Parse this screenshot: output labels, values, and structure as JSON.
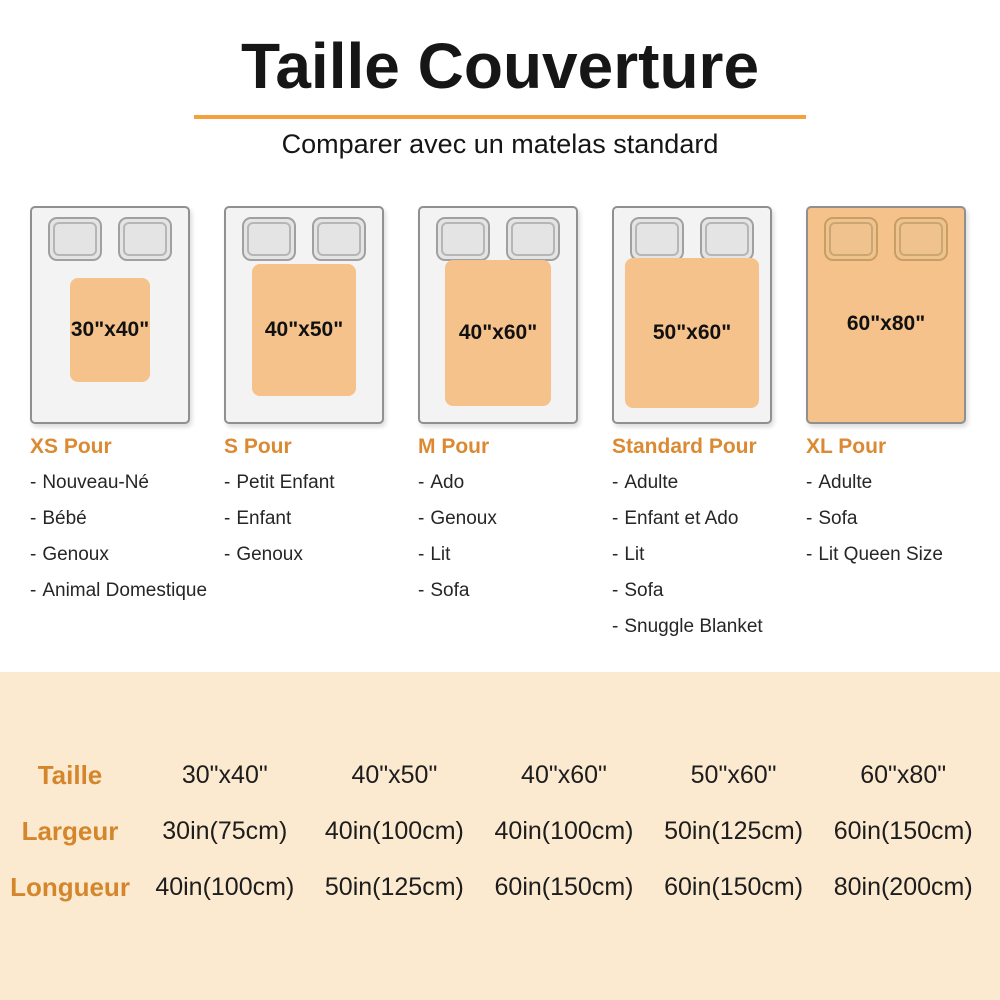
{
  "header": {
    "title": "Taille Couverture",
    "subtitle": "Comparer avec un matelas standard"
  },
  "bullet": "-",
  "beds": [
    {
      "blanket_size": "30\"x40\"",
      "category": "XS Pour",
      "uses": [
        "Nouveau-Né",
        "Bébé",
        "Genoux",
        "Animal Domestique"
      ]
    },
    {
      "blanket_size": "40\"x50\"",
      "category": "S Pour",
      "uses": [
        "Petit Enfant",
        "Enfant",
        "Genoux"
      ]
    },
    {
      "blanket_size": "40\"x60\"",
      "category": "M Pour",
      "uses": [
        "Ado",
        "Genoux",
        "Lit",
        "Sofa"
      ]
    },
    {
      "blanket_size": "50\"x60\"",
      "category": "Standard Pour",
      "uses": [
        "Adulte",
        "Enfant et Ado",
        "Lit",
        "Sofa",
        "Snuggle Blanket"
      ]
    },
    {
      "blanket_size": "60\"x80\"",
      "category": "XL Pour",
      "uses": [
        "Adulte",
        "Sofa",
        "Lit Queen Size"
      ]
    }
  ],
  "size_table": {
    "rows": [
      {
        "label": "Taille",
        "values": [
          "30\"x40\"",
          "40\"x50\"",
          "40\"x60\"",
          "50\"x60\"",
          "60\"x80\""
        ]
      },
      {
        "label": "Largeur",
        "values": [
          "30in(75cm)",
          "40in(100cm)",
          "40in(100cm)",
          "50in(125cm)",
          "60in(150cm)"
        ]
      },
      {
        "label": "Longueur",
        "values": [
          "40in(100cm)",
          "50in(125cm)",
          "60in(150cm)",
          "60in(150cm)",
          "80in(200cm)"
        ]
      }
    ]
  },
  "colors": {
    "accent_orange": "#F5A03C",
    "heading_orange": "#DB8A33",
    "table_label_orange": "#D4862C",
    "blanket_orange": "#F6C28B",
    "table_background": "#FCEAD0"
  }
}
